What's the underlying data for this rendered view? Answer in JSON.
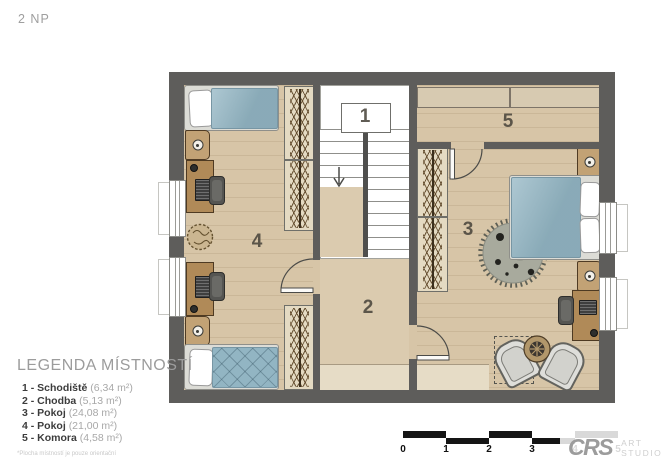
{
  "page": {
    "title": "2 NP"
  },
  "plan": {
    "rooms": [
      {
        "label": "1"
      },
      {
        "label": "2"
      },
      {
        "label": "3"
      },
      {
        "label": "4"
      },
      {
        "label": "5"
      }
    ]
  },
  "legend": {
    "title": "LEGENDA MÍSTNOSTÍ",
    "items": [
      {
        "label": "1 - Schodiště",
        "area": "(6,34 m²)"
      },
      {
        "label": "2 - Chodba",
        "area": "(5,13 m²)"
      },
      {
        "label": "3 - Pokoj",
        "area": "(24,08 m²)"
      },
      {
        "label": "4 - Pokoj",
        "area": "(21,00 m²)"
      },
      {
        "label": "5 - Komora",
        "area": "(4,58 m²)"
      }
    ],
    "footnote": "*Plocha místností je pouze orientační"
  },
  "scalebar": {
    "labels": [
      "0",
      "1",
      "2",
      "3",
      "4",
      "5"
    ]
  },
  "watermark": {
    "brand": "CRS",
    "line1": "ART",
    "line2": "STUDIO"
  },
  "colors": {
    "wall": "#5e5d5b",
    "floor": "#d7c5a7",
    "floor_light": "#e6dcc6",
    "duvet_blue": "#92b5c3",
    "wood": "#b08a58",
    "rug": "#a8aa9d"
  }
}
